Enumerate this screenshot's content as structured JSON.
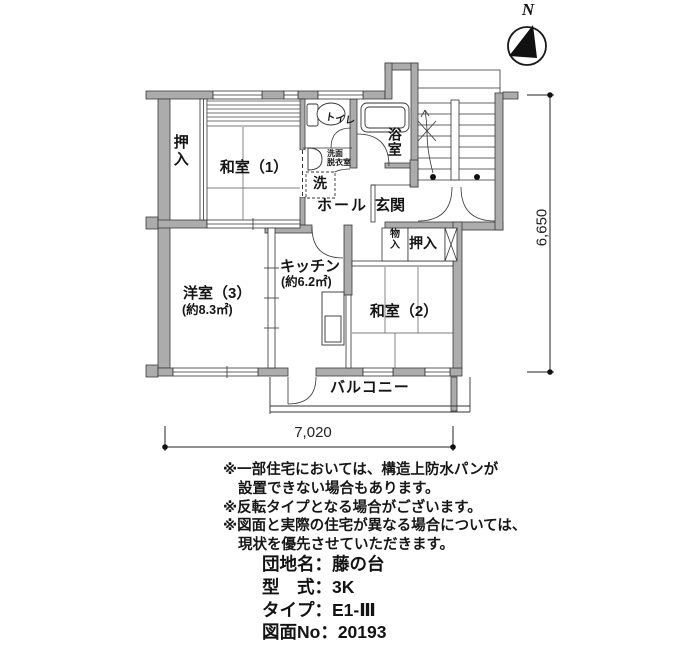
{
  "compass": {
    "north_label": "N"
  },
  "rooms": {
    "oshiire_left": "押入",
    "washitsu1": "和室（1）",
    "toilet": "トイレ",
    "senmen_datsuiishitsu": "洗面\n脱衣室",
    "laundry": "洗",
    "bath": "浴室",
    "hall": "ホール",
    "genkan": "玄関",
    "mono_ire": "物\n入",
    "oshiire_right": "押入",
    "washitsu2": "和室（2）",
    "kitchen": "キッチン",
    "kitchen_area": "(約6.2㎡)",
    "youshitsu3": "洋室（3）",
    "youshitsu3_area": "(約8.3㎡)",
    "balcony": "バルコニー"
  },
  "dimensions": {
    "width_mm": "7,020",
    "height_mm": "6,650"
  },
  "notes": {
    "lines": [
      "※一部住宅においては、構造上防水パンが",
      "設置できない場合もあります。",
      "※反転タイプとなる場合がございます。",
      "※図面と実際の住宅が異なる場合については、",
      "現状を優先させていただきます。"
    ]
  },
  "property_info": {
    "items": [
      {
        "label": "団地名：",
        "value": "藤の台"
      },
      {
        "label": "型　式：",
        "value": "3K"
      },
      {
        "label": "タイプ：",
        "value": "E1-Ⅲ"
      },
      {
        "label": "図面No：",
        "value": "20193"
      }
    ]
  },
  "colors": {
    "wall_fill": "#acacac",
    "line": "#333333",
    "text": "#111111"
  }
}
